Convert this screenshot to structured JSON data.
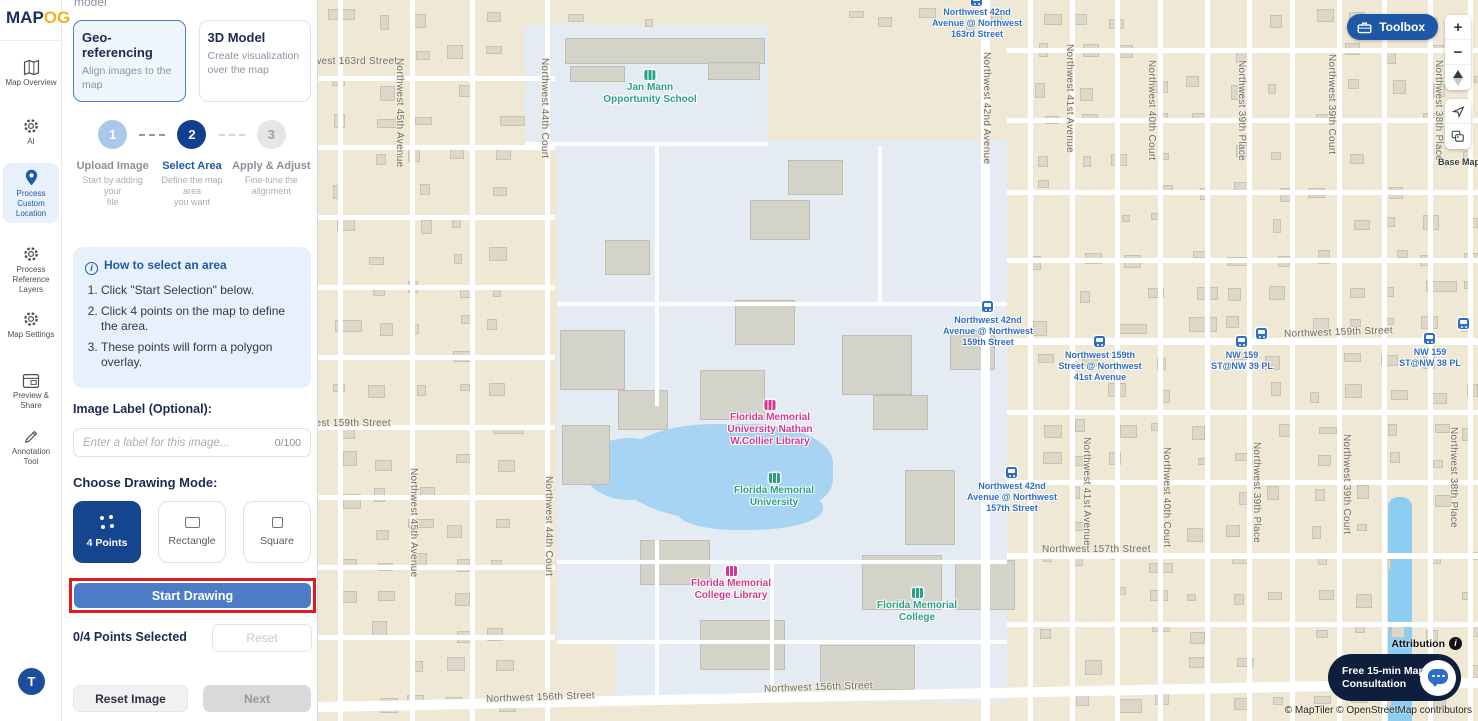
{
  "app": {
    "logo_map": "MAP",
    "logo_og": "OG",
    "panel_cut_text": "model"
  },
  "icons": {
    "collapse": "›",
    "zoom_in": "+",
    "zoom_out": "−",
    "info_i": "i"
  },
  "sidebar": {
    "items": [
      {
        "label": "Map Overview",
        "icon": "map-icon"
      },
      {
        "label": "AI",
        "icon": "gear-icon"
      },
      {
        "label": "Process Custom Location",
        "icon": "pin-icon",
        "active": true
      },
      {
        "label": "Process Reference Layers",
        "icon": "layers-gear-icon"
      },
      {
        "label": "Map Settings",
        "icon": "settings-gear-icon"
      },
      {
        "label": "Preview & Share",
        "icon": "window-icon"
      },
      {
        "label": "Annotation Tool",
        "icon": "pen-icon"
      }
    ],
    "avatar": "T"
  },
  "panel": {
    "cards": [
      {
        "title": "Geo-referencing",
        "subtitle": "Align images to the map",
        "selected": true
      },
      {
        "title": "3D Model",
        "subtitle": "Create visualization over the map",
        "selected": false
      }
    ],
    "steps": [
      {
        "num": "1",
        "label": "Upload Image",
        "sub1": "Start by adding your",
        "sub2": "file",
        "state": "done"
      },
      {
        "num": "2",
        "label": "Select Area",
        "sub1": "Define the map area",
        "sub2": "you want",
        "state": "active"
      },
      {
        "num": "3",
        "label": "Apply & Adjust",
        "sub1": "Fine-tune the",
        "sub2": "alignment",
        "state": "pending"
      }
    ],
    "help": {
      "title": "How to select an area",
      "items": [
        "Click \"Start Selection\" below.",
        "Click 4 points on the map to define the area.",
        "These points will form a polygon overlay."
      ]
    },
    "image_label": {
      "title": "Image Label (Optional):",
      "placeholder": "Enter a label for this image...",
      "counter": "0/100"
    },
    "drawing_mode": {
      "title": "Choose Drawing Mode:",
      "options": [
        {
          "label": "4 Points",
          "active": true
        },
        {
          "label": "Rectangle",
          "active": false
        },
        {
          "label": "Square",
          "active": false
        }
      ]
    },
    "start_drawing": "Start Drawing",
    "points_selected": "0/4 Points Selected",
    "reset": "Reset",
    "reset_image": "Reset Image",
    "next": "Next"
  },
  "map": {
    "toolbox_label": "Toolbox",
    "basemap_label": "Base Map",
    "attribution_label": "Attribution",
    "consultation_line1": "Free 15-min Map",
    "consultation_line2": "Consultation",
    "credits": "© MapTiler © OpenStreetMap contributors",
    "street_labels": [
      {
        "text": "Northwest 163rd Street",
        "x": -30,
        "y": 56,
        "dir": "h"
      },
      {
        "text": "Northwest 159th Street",
        "x": -36,
        "y": 418,
        "dir": "h"
      },
      {
        "text": "Northwest 159th Street",
        "x": 966,
        "y": 327,
        "dir": "h",
        "rot": -2
      },
      {
        "text": "Northwest 157th Street",
        "x": 724,
        "y": 544,
        "dir": "h"
      },
      {
        "text": "Northwest 156th Street",
        "x": 168,
        "y": 692,
        "dir": "h",
        "rot": -2
      },
      {
        "text": "Northwest 156th Street",
        "x": 446,
        "y": 682,
        "dir": "h",
        "rot": -2
      },
      {
        "text": "Northwest 45th Avenue",
        "x": 76,
        "y": 58,
        "dir": "v"
      },
      {
        "text": "Northwest 45th Avenue",
        "x": 90,
        "y": 468,
        "dir": "v"
      },
      {
        "text": "Northwest 44th Court",
        "x": 221,
        "y": 58,
        "dir": "v"
      },
      {
        "text": "Northwest 44th Court",
        "x": 225,
        "y": 476,
        "dir": "v"
      },
      {
        "text": "Northwest 42nd Avenue",
        "x": 663,
        "y": 52,
        "dir": "v"
      },
      {
        "text": "Northwest 41st Avenue",
        "x": 746,
        "y": 44,
        "dir": "v"
      },
      {
        "text": "Northwest 41st Avenue",
        "x": 763,
        "y": 437,
        "dir": "v"
      },
      {
        "text": "Northwest 40th Court",
        "x": 828,
        "y": 60,
        "dir": "v"
      },
      {
        "text": "Northwest 40th Court",
        "x": 843,
        "y": 447,
        "dir": "v"
      },
      {
        "text": "Northwest 39th Place",
        "x": 918,
        "y": 60,
        "dir": "v"
      },
      {
        "text": "Northwest 39th Place",
        "x": 933,
        "y": 442,
        "dir": "v"
      },
      {
        "text": "Northwest 39th Court",
        "x": 1008,
        "y": 54,
        "dir": "v"
      },
      {
        "text": "Northwest 39th Court",
        "x": 1023,
        "y": 434,
        "dir": "v"
      },
      {
        "text": "Northwest 38th Place",
        "x": 1115,
        "y": 60,
        "dir": "v"
      },
      {
        "text": "Northwest 38th Place",
        "x": 1130,
        "y": 427,
        "dir": "v"
      }
    ],
    "poi_labels": [
      {
        "lines": [
          "Jan Mann",
          "Opportunity School"
        ],
        "x": 332,
        "y": 70,
        "color": "green",
        "icon": "school-icon"
      },
      {
        "lines": [
          "Florida Memorial",
          "University Nathan",
          "W.Collier Library"
        ],
        "x": 452,
        "y": 400,
        "color": "pink",
        "icon": "library-icon"
      },
      {
        "lines": [
          "Florida Memorial",
          "University"
        ],
        "x": 456,
        "y": 473,
        "color": "green",
        "icon": "school-icon"
      },
      {
        "lines": [
          "Florida Memorial",
          "College Library"
        ],
        "x": 413,
        "y": 566,
        "color": "pink",
        "icon": "library-icon"
      },
      {
        "lines": [
          "Florida Memorial",
          "College"
        ],
        "x": 599,
        "y": 588,
        "color": "green",
        "icon": "school-icon"
      }
    ],
    "transit_labels": [
      {
        "lines": [
          "Northwest 42nd",
          "Avenue @ Northwest",
          "163rd Street"
        ],
        "x": 659,
        "y": 7,
        "icon_dy": -12
      },
      {
        "lines": [
          "Northwest 42nd",
          "Avenue @ Northwest",
          "159th Street"
        ],
        "x": 670,
        "y": 315,
        "icon_dy": -14
      },
      {
        "lines": [
          "Northwest 159th",
          "Street @ Northwest",
          "41st Avenue"
        ],
        "x": 782,
        "y": 350,
        "icon_dy": -14
      },
      {
        "lines": [
          "NW 159",
          "ST@NW 39 PL"
        ],
        "x": 924,
        "y": 350,
        "icon_dy": -14
      },
      {
        "lines": [
          "NW 159",
          "ST@NW 38 PL"
        ],
        "x": 1112,
        "y": 347,
        "icon_dy": -14
      },
      {
        "lines": [
          "Northwest 42nd",
          "Avenue @ Northwest",
          "157th Street"
        ],
        "x": 694,
        "y": 481,
        "icon_dy": -14
      }
    ]
  }
}
